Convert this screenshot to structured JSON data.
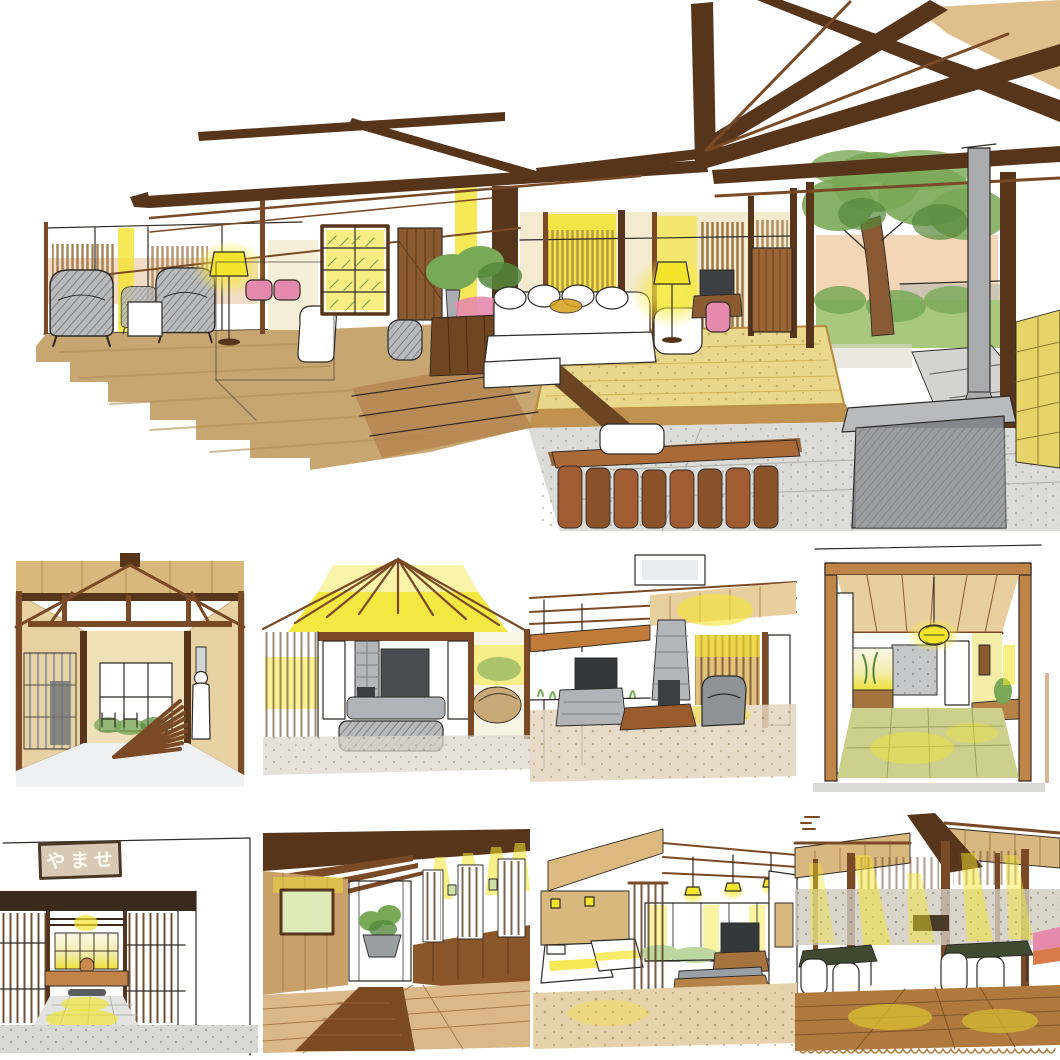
{
  "artwork": {
    "type": "hand-drawn marker sketch collage of ryokan interiors",
    "sign": {
      "text": "やませ"
    },
    "palette": {
      "ink": "#2e2a26",
      "beam_dark": "#56351b",
      "beam_mid": "#7a4a26",
      "wood_light": "#c08448",
      "wood_pale": "#dcb97f",
      "tan_floor": "#c8a671",
      "wall_tan": "#e8d2a4",
      "glow_yellow": "#f3e42e",
      "tatami_green": "#cdd08d",
      "foliage_green": "#79a857",
      "foliage_dark": "#55883c",
      "accent_pink": "#e589ad",
      "stone_gray": "#c9cbcd",
      "stove_gray": "#85878a",
      "plank_brown": "#a05c32",
      "carpet_brown": "#7a4a22"
    }
  }
}
